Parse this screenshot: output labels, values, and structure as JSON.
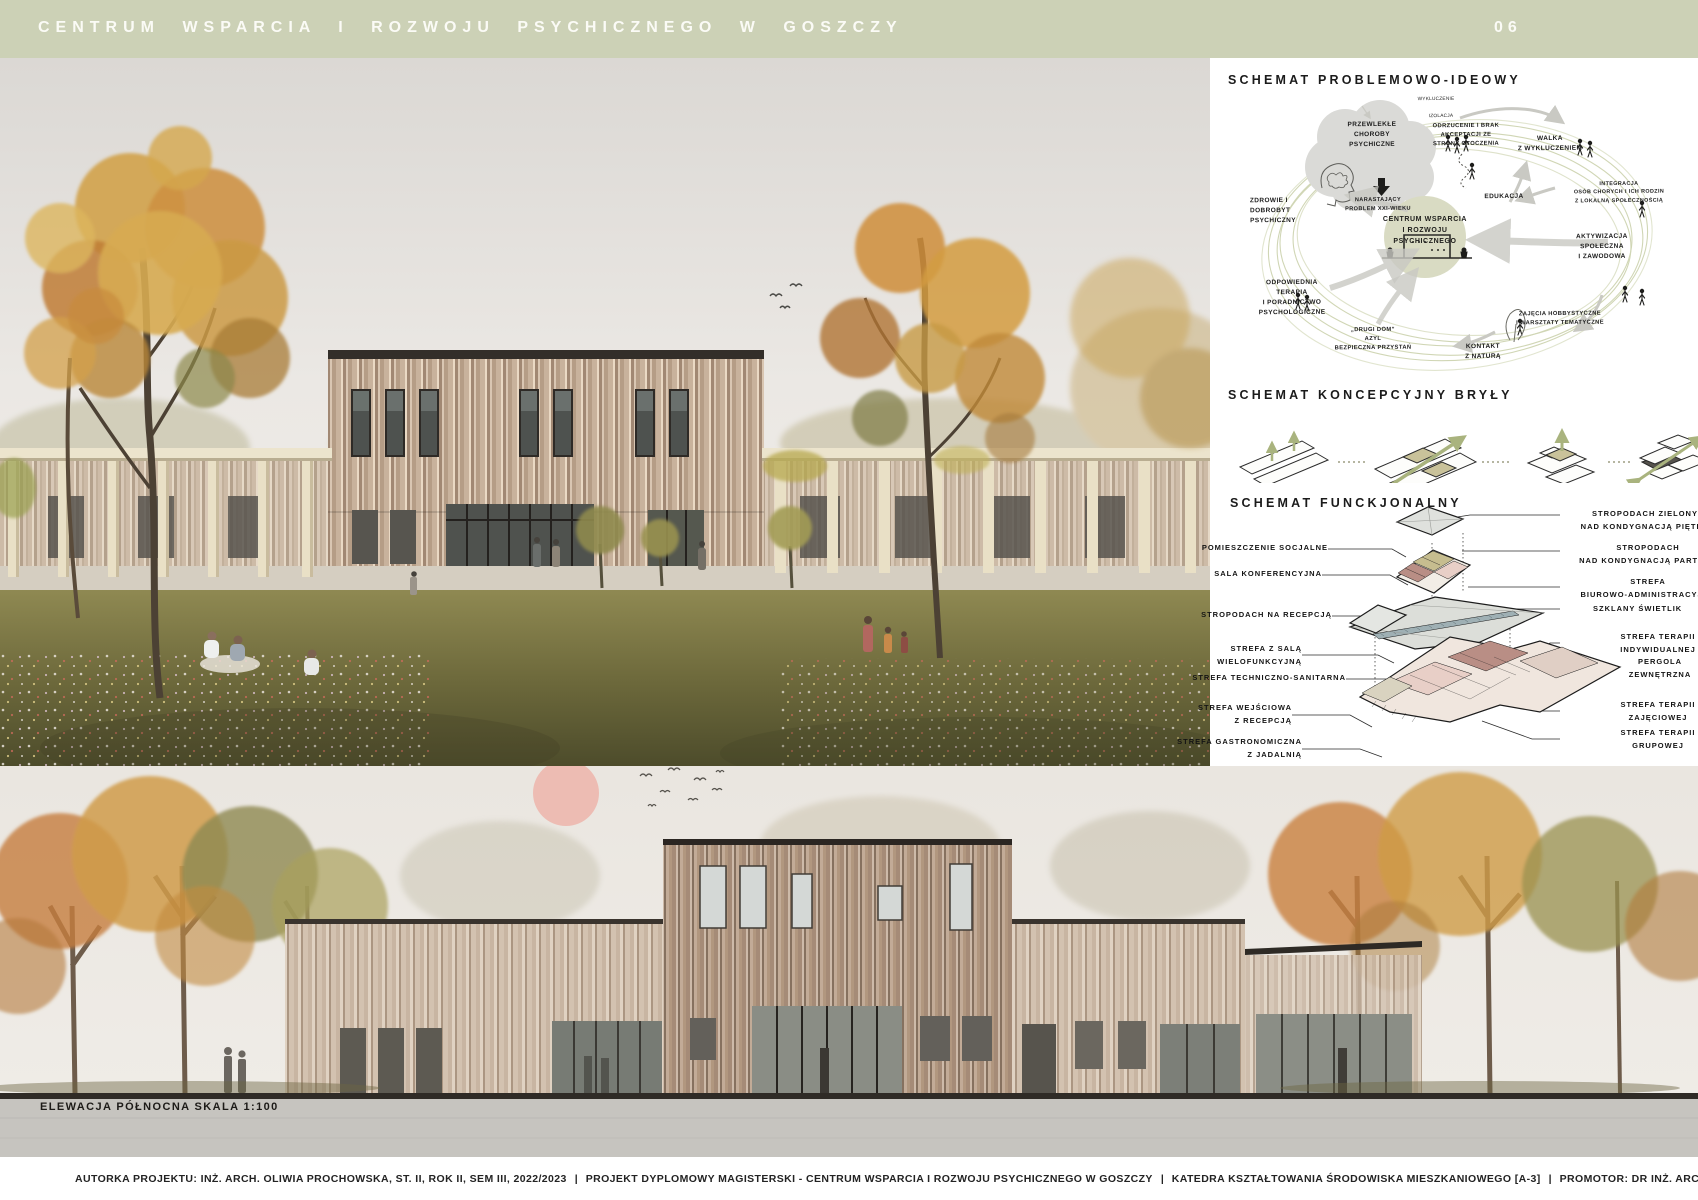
{
  "header": {
    "title": "CENTRUM WSPARCIA I ROZWOJU PSYCHICZNEGO W GOSZCZY",
    "page_number": "06"
  },
  "colors": {
    "header_green": "#ccd1b6",
    "accent_green": "#a9b37e",
    "ring_green": "#ccd2ad",
    "sun_pink": "#edb7ae",
    "axon_olive": "#c6bd8f",
    "axon_mauve": "#b98e85",
    "axon_pink": "#e8cfc7",
    "timber": "#c8b29c",
    "ink": "#1c1c1c"
  },
  "idea": {
    "heading": "SCHEMAT PROBLEMOWO-IDEOWY",
    "center": "CENTRUM WSPARCIA\nI ROZWOJU PSYCHICZNEGO",
    "cloud_title": "PRZEWLEKŁE\nCHOROBY\nPSYCHICZNE",
    "cloud_sub": "NARASTAJĄCY\nPROBLEM XXI-WIEKU",
    "labels": {
      "wykluczenie": "WYKLUCZENIE",
      "izolacja": "IZOLACJA",
      "odrzucenie": "ODRZUCENIE I BRAK\nAKCEPTACJI ZE\nSTRONY OTOCZENIA",
      "walka": "WALKA\nZ WYKLUCZENIEM",
      "edukacja": "EDUKACJA",
      "integracja": "INTEGRACJA\nOSÓB CHORYCH I ICH RODZIN\nZ LOKALNĄ SPOŁECZNOŚCIĄ",
      "aktywizacja": "AKTYWIZACJA\nSPOŁECZNA\nI ZAWODOWA",
      "zajecia": "ZAJĘCIA HOBBYSTYCZNE\nI WARSZTATY TEMATYCZNE",
      "kontakt": "KONTAKT\nZ NATURĄ",
      "drugi_dom": "„DRUGI DOM”\nAZYL\nBEZPIECZNA PRZYSTAŃ",
      "terapia": "ODPOWIEDNIA\nTERAPIA\nI PORADNICTWO\nPSYCHOLOGICZNE",
      "zdrowie": "ZDROWIE I\nDOBROBYT\nPSYCHICZNY"
    }
  },
  "concept": {
    "heading": "SCHEMAT KONCEPCYJNY BRYŁY"
  },
  "functional": {
    "heading": "SCHEMAT FUNCKJONALNY",
    "left": [
      "POMIESZCZENIE SOCJALNE",
      "SALA KONFERENCYJNA",
      "STROPODACH NA RECEPCJĄ",
      "STREFA Z SALĄ\nWIELOFUNKCYJNĄ",
      "STREFA TECHNICZNO-SANITARNA",
      "STREFA WEJŚCIOWA\nZ RECEPCJĄ",
      "STREFA GASTRONOMICZNA\nZ JADALNIĄ"
    ],
    "right": [
      "STROPODACH ZIELONY\nNAD KONDYGNACJĄ PIĘTRA",
      "STROPODACH\nNAD KONDYGNACJĄ PARTERU",
      "STREFA\nBIUROWO-ADMINISTRACYJNA",
      "SZKLANY ŚWIETLIK",
      "STREFA TERAPII\nINDYWIDUALNEJ",
      "PERGOLA\nZEWNĘTRZNA",
      "STREFA TERAPII\nZAJĘCIOWEJ",
      "STREFA TERAPII\nGRUPOWEJ"
    ]
  },
  "elevation": {
    "label": "ELEWACJA PÓŁNOCNA SKALA 1:100"
  },
  "footer": {
    "divider": "|",
    "items": [
      "AUTORKA PROJEKTU: INŻ. ARCH. OLIWIA PROCHOWSKA, ST. II, ROK II, SEM III, 2022/2023",
      "PROJEKT DYPLOMOWY MAGISTERSKI - CENTRUM WSPARCIA I ROZWOJU PSYCHICZNEGO W GOSZCZY",
      "KATEDRA KSZTAŁTOWANIA ŚRODOWISKA MIESZKANIOWEGO [A-3]",
      "PROMOTOR: DR INŻ. ARCH. PIOTR CELEWICZ"
    ]
  }
}
